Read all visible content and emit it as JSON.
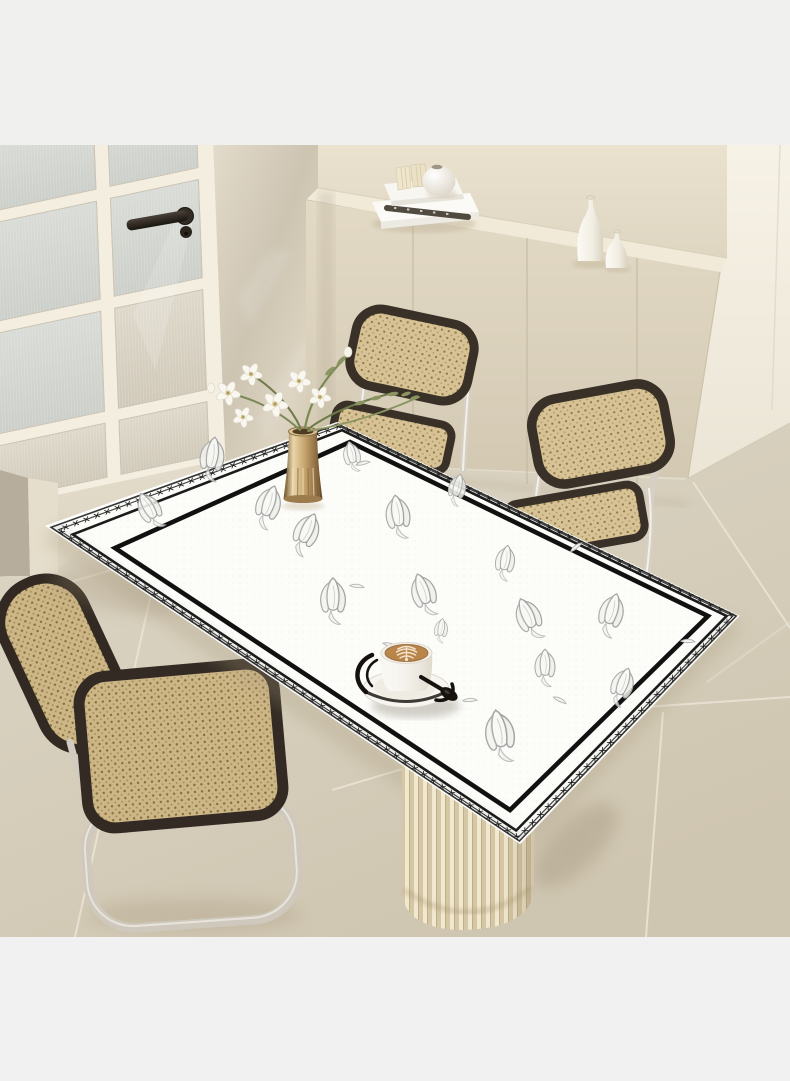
{
  "image": {
    "type": "product-photo",
    "subject": "white leather tablecloth with black stitched border and tulip sketches on a dining table",
    "setting": "beige minimalist dining room with glass door, cream sideboard and cane chairs"
  },
  "palette": {
    "backdrop_top": "#f0f0ee",
    "backdrop_bottom": "#f0f1f0",
    "wall_light": "#f0eadd",
    "wall_dark": "#ddd4c2",
    "wall_above_cabinet": "#e7dfcb",
    "wall_bright_right": "#f5f0e4",
    "door_frame": "#f4eee1",
    "door_glass_cool": "#d8dad5",
    "door_glass_warm": "#ddd7c9",
    "door_handle": "#2e2822",
    "cabinet_front": "#ddd4c0",
    "cabinet_top": "#f1ead9",
    "floor_tile": "#d8d0be",
    "floor_grout": "#ebe5d7",
    "chair_frame": "#393027",
    "cane": "#d6c294",
    "cane_dot": "#8f7849",
    "chrome": "#d6d0c4",
    "cloth_white": "#fcfcf9",
    "border_ink": "#161616",
    "sketch_grey": "#a7a7a7",
    "vase_gold": "#c5a36c",
    "leaf_green": "#7c8856",
    "flower_white": "#f9f7f0",
    "coffee_tan": "#b98549",
    "pedestal_light": "#f1e8d0",
    "pedestal_dark": "#d5c7a5",
    "bottle_white": "#faf8f3",
    "shadow_warm": "#a99b7f"
  },
  "door": {
    "columns": 2,
    "pane_rows": 4,
    "glass": "reeded-frosted",
    "handle": "dark-bronze-lever"
  },
  "cabinet": {
    "panel_seams": 3,
    "decor": {
      "books_stacked": 2,
      "mini_books": 2,
      "spine_marks": 5,
      "round_vase": 1,
      "bottle_vases": 2
    }
  },
  "chairs": {
    "count": 3,
    "style": "cantilever cane chairs, chrome frame, dark trim",
    "positions": [
      "behind-table",
      "right-of-table",
      "front-left"
    ]
  },
  "table": {
    "pedestal": {
      "style": "fluted-cylinder"
    },
    "tablecloth": {
      "shape": "rectangle in perspective",
      "border": {
        "outer_line_px": 1.6,
        "mid_line_px": 2.6,
        "inner_line_px": 4.6,
        "stitch_glyph": "×",
        "stitch_repeat": 180,
        "stitch_font_px": 9.5,
        "stitch_spacing_px": 3.2
      },
      "motif": "tulip line sketches",
      "tulips": [
        [
          150,
          510,
          -30,
          0.9
        ],
        [
          212,
          458,
          8,
          1
        ],
        [
          268,
          506,
          18,
          1
        ],
        [
          352,
          456,
          -12,
          0.7
        ],
        [
          306,
          533,
          24,
          1
        ],
        [
          398,
          516,
          -8,
          1
        ],
        [
          457,
          489,
          14,
          0.72
        ],
        [
          333,
          600,
          0,
          1.05
        ],
        [
          424,
          594,
          -18,
          1
        ],
        [
          505,
          562,
          10,
          0.8
        ],
        [
          529,
          618,
          -24,
          1
        ],
        [
          611,
          614,
          16,
          1
        ],
        [
          545,
          667,
          0,
          0.85
        ],
        [
          500,
          735,
          -10,
          1.2
        ],
        [
          622,
          686,
          20,
          0.9
        ],
        [
          441,
          630,
          8,
          0.55
        ]
      ],
      "petal_dashes": [
        [
          357,
          586,
          20
        ],
        [
          305,
          489,
          -15
        ],
        [
          390,
          645,
          30
        ],
        [
          470,
          700,
          10
        ],
        [
          576,
          547,
          -25
        ],
        [
          688,
          641,
          15
        ],
        [
          363,
          463,
          0
        ],
        [
          560,
          700,
          40
        ]
      ]
    }
  },
  "decor": {
    "flower_vase": {
      "vase": "gold fluted cylinder",
      "flowers": "white orchids",
      "flower_count": 6,
      "greenery": "olive sprigs"
    },
    "coffee": {
      "cup": "white",
      "latte_art": "rosetta",
      "saucer": "white with black rim",
      "spoon": "black",
      "holder": "black wire"
    }
  }
}
